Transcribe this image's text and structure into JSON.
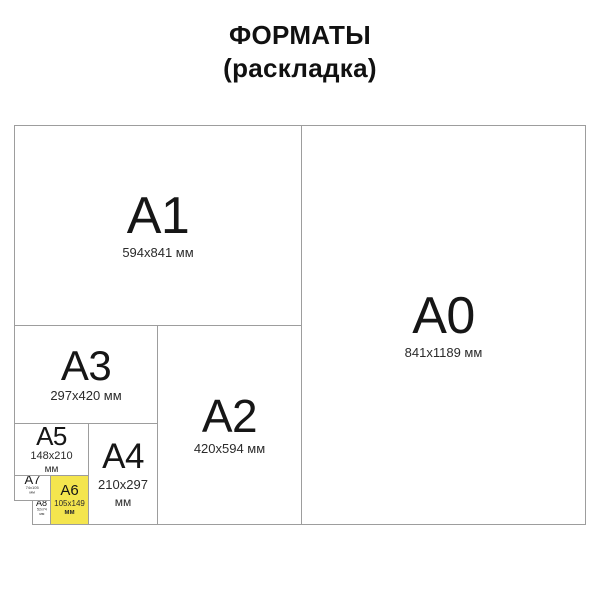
{
  "title": {
    "line1": "ФОРМАТЫ",
    "line2": "(раскладка)"
  },
  "formats": {
    "a0": {
      "label": "A0",
      "dims": "841x1189 мм"
    },
    "a1": {
      "label": "A1",
      "dims": "594x841 мм"
    },
    "a2": {
      "label": "A2",
      "dims": "420x594 мм"
    },
    "a3": {
      "label": "A3",
      "dims": "297x420 мм"
    },
    "a4": {
      "label": "A4",
      "dims": "210x297",
      "unit": "мм"
    },
    "a5": {
      "label": "A5",
      "dims": "148x210",
      "unit": "мм"
    },
    "a6": {
      "label": "A6",
      "dims": "105x149",
      "unit": "мм"
    },
    "a7": {
      "label": "A7",
      "dims": "74x105",
      "unit": "мм"
    },
    "a8": {
      "label": "A8",
      "dims": "52x74",
      "unit": "мм"
    }
  },
  "colors": {
    "highlight": "#f4e54e",
    "line": "#9d9d9d"
  }
}
